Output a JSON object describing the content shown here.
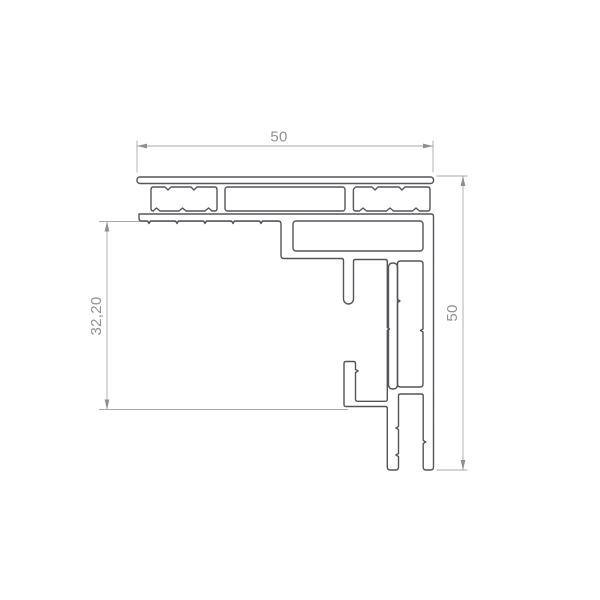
{
  "drawing": {
    "title": "aluminium-corner-profile-cross-section",
    "background_color": "#ffffff",
    "line_color": "#545559",
    "dimension_line_color": "#a8a9ab",
    "arrow_color": "#8d8f91",
    "dimension_text_color": "#8f9193",
    "dimensions": {
      "top_width": {
        "label": "50",
        "orientation": "horizontal"
      },
      "right_height": {
        "label": "50",
        "orientation": "vertical"
      },
      "left_inner_height": {
        "label": "32,20",
        "orientation": "vertical"
      }
    }
  }
}
